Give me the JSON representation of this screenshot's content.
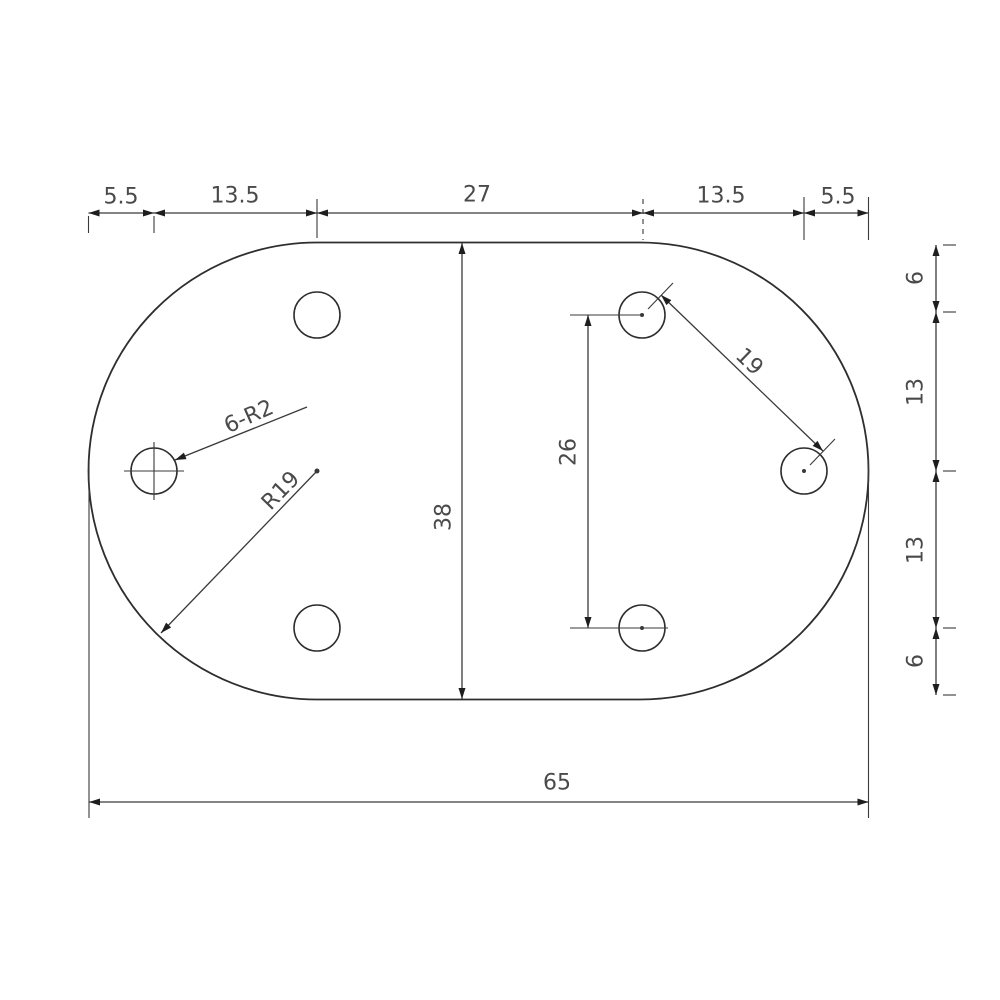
{
  "drawing": {
    "type": "engineering-dimension-drawing",
    "part": {
      "shape": "obround-plate",
      "overall_width": 65,
      "overall_height": 38,
      "end_radius": 19,
      "hole_count": 6,
      "hole_radius": 2
    },
    "labels": {
      "top_chain": {
        "seg1": "5.5",
        "seg2": "13.5",
        "seg3": "27",
        "seg4": "13.5",
        "seg5": "5.5"
      },
      "right_chain": {
        "seg1": "6",
        "seg2": "13",
        "seg3": "13",
        "seg4": "6"
      },
      "overall_height": "38",
      "hole_spacing_vertical": "26",
      "hole_spacing_diagonal": "19",
      "hole_callout": "6-R2",
      "end_radius_callout": "R19",
      "overall_width": "65"
    },
    "colors": {
      "background": "#ffffff",
      "outline": "#2e2e2e",
      "dimension_lines": "#3a3a3a",
      "text": "#4a4a4a"
    }
  }
}
